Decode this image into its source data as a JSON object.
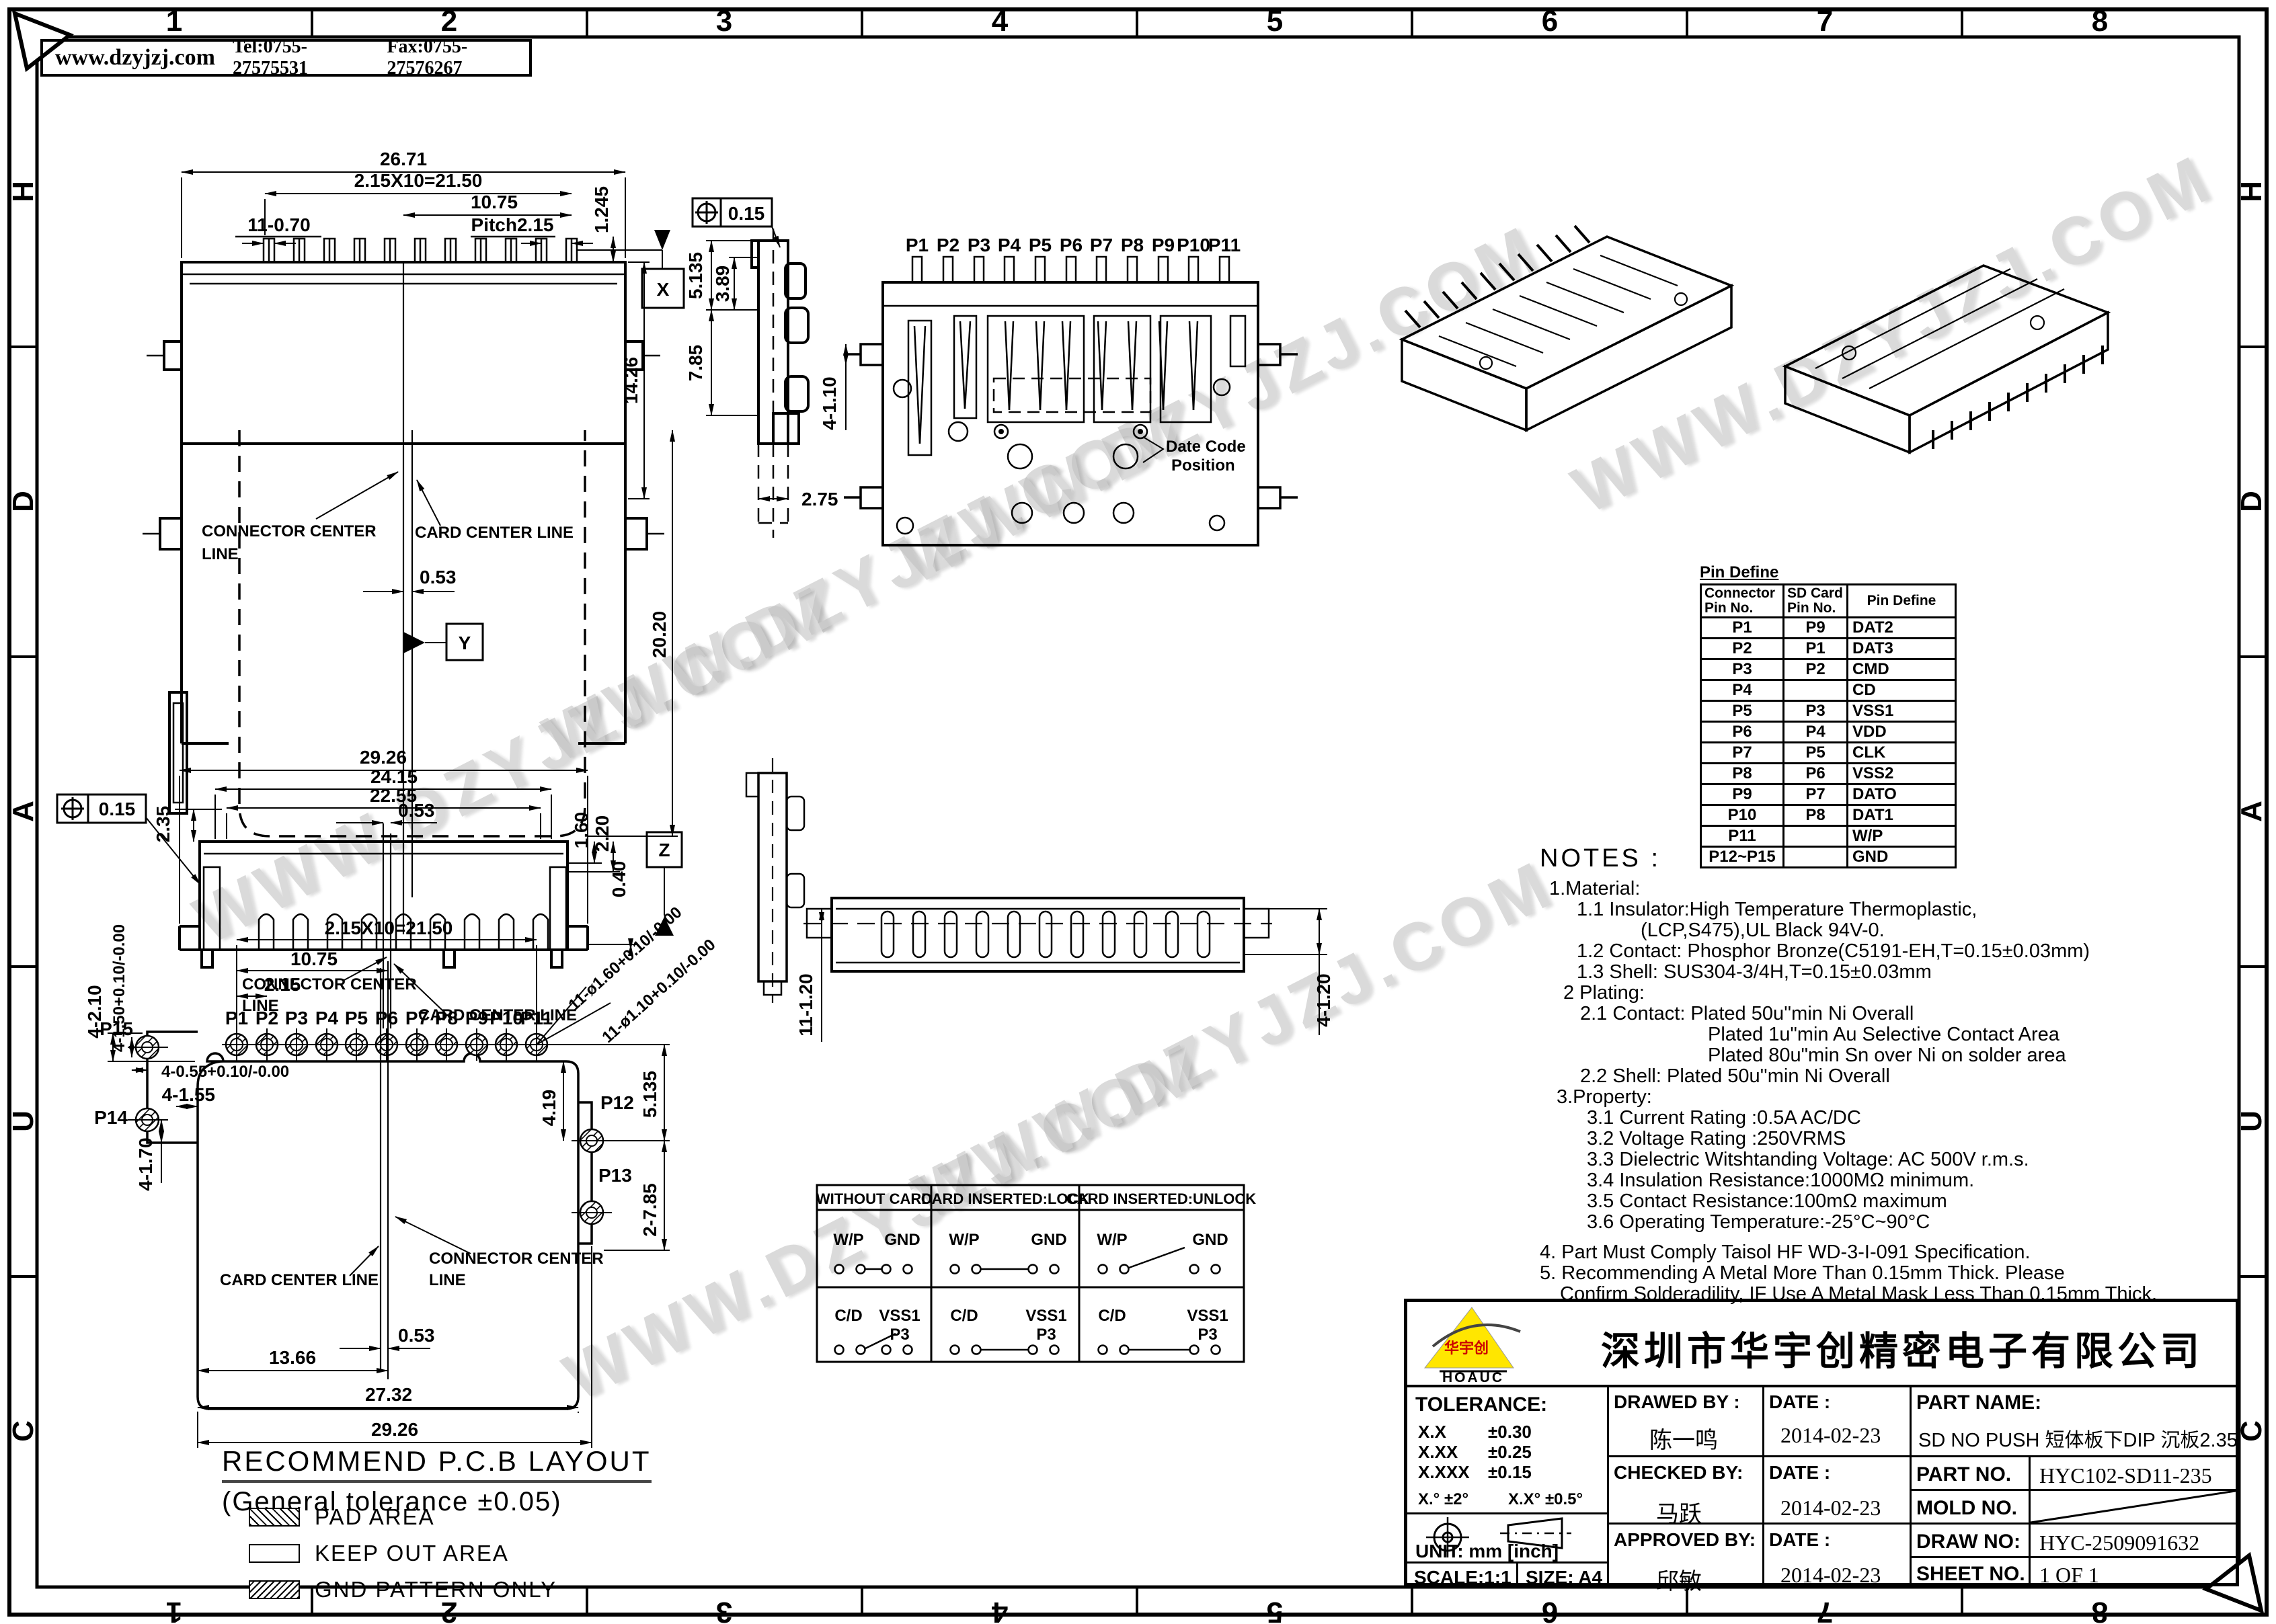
{
  "page": {
    "website": "www.dzyjzj.com",
    "tel": "Tel:0755-27575531",
    "fax": "Fax:0755-27576267",
    "watermark": "WWW.DZYJZJ.COM",
    "zones_top": [
      "1",
      "2",
      "3",
      "4",
      "5",
      "6",
      "7",
      "8"
    ],
    "zones_bottom": [
      "8",
      "7",
      "6",
      "5",
      "4",
      "3",
      "2",
      "1"
    ],
    "zones_left": [
      "H",
      "D",
      "A",
      "U",
      "C"
    ],
    "zones_right": [
      "H",
      "D",
      "A",
      "U",
      "C"
    ]
  },
  "top_view": {
    "dim_26_71": "26.71",
    "dim_21_50": "2.15X10=21.50",
    "dim_10_75": "10.75",
    "dim_pitch": "Pitch2.15",
    "dim_11_070": "11-0.70",
    "dim_1_245": "1.245",
    "dim_14_26": "14.26",
    "dim_20_20": "20.20",
    "dim_0_53": "0.53",
    "datum_x": "X",
    "datum_y": "Y",
    "connector_center_1": "CONNECTOR CENTER",
    "connector_center_2": "LINE",
    "card_center": "CARD CENTER LINE"
  },
  "side_view": {
    "fcf": "0.15",
    "dim_5_135": "5.135",
    "dim_3_89": "3.89",
    "dim_7_85": "7.85",
    "dim_2_75": "2.75"
  },
  "bottom_view_top": {
    "pins": [
      "P1",
      "P2",
      "P3",
      "P4",
      "P5",
      "P6",
      "P7",
      "P8",
      "P9",
      "P10",
      "P11"
    ],
    "date_code_1": "Date Code",
    "date_code_2": "Position",
    "dim_4_110": "4-1.10"
  },
  "front_view": {
    "dim_29_26": "29.26",
    "dim_24_15": "24.15",
    "dim_22_55": "22.55",
    "dim_0_53": "0.53",
    "dim_2_35": "2.35",
    "fcf": "0.15",
    "dim_1_60": "1.60",
    "dim_2_20": "2.20",
    "dim_0_40": "0.40",
    "datum_z": "Z",
    "connector_center_1": "CONNECTOR CENTER",
    "connector_center_2": "LINE",
    "card_center": "CARD CENTER LINE"
  },
  "bottom_view2": {
    "dim_11_120": "11-1.20",
    "dim_4_120": "4-1.20"
  },
  "pcb": {
    "dim_21_50": "2.15X10=21.50",
    "dim_10_75": "10.75",
    "dim_2_15": "2.15",
    "pins": [
      "P1",
      "P2",
      "P3",
      "P4",
      "P5",
      "P6",
      "P7",
      "P8",
      "P9",
      "P10",
      "P11"
    ],
    "hole_160": "11-ø1.60+0.10/-0.00",
    "hole_110": "11-ø1.10+0.10/-0.00",
    "dim_4_19": "4.19",
    "dim_5_135": "5.135",
    "dim_2_785": "2-7.85",
    "p12": "P12",
    "p13": "P13",
    "p14": "P14",
    "p15": "P15",
    "dim_4_210": "4-2.10",
    "dim_4_150": "4-1.50+0.10/-0.00",
    "dim_4_055": "4-0.55+0.10/-0.00",
    "dim_4_155": "4-1.55",
    "dim_4_170": "4-1.70",
    "card_center": "CARD CENTER LINE",
    "connector_center_1": "CONNECTOR CENTER",
    "connector_center_2": "LINE",
    "dim_0_53": "0.53",
    "dim_13_66": "13.66",
    "dim_27_32": "27.32",
    "dim_29_26": "29.26",
    "title": "RECOMMEND P.C.B LAYOUT",
    "subtitle": "(General tolerance ±0.05)",
    "legend": [
      {
        "label": "PAD AREA"
      },
      {
        "label": "KEEP OUT AREA"
      },
      {
        "label": "GND PATTERN ONLY"
      }
    ]
  },
  "switch_table": {
    "headers": [
      "WITHOUT CARD",
      "CARD INSERTED:LOCK",
      "CARD INSERTED:UNLOCK"
    ],
    "wp": "W/P",
    "gnd": "GND",
    "cd": "C/D",
    "vss1": "VSS1",
    "p3": "P3"
  },
  "pin_table": {
    "title": "Pin Define",
    "col1a": "Connector",
    "col1b": "Pin No.",
    "col2a": "SD Card",
    "col2b": "Pin No.",
    "col3": "Pin Define",
    "rows": [
      [
        "P1",
        "P9",
        "DAT2"
      ],
      [
        "P2",
        "P1",
        "DAT3"
      ],
      [
        "P3",
        "P2",
        "CMD"
      ],
      [
        "P4",
        "",
        "CD"
      ],
      [
        "P5",
        "P3",
        "VSS1"
      ],
      [
        "P6",
        "P4",
        "VDD"
      ],
      [
        "P7",
        "P5",
        "CLK"
      ],
      [
        "P8",
        "P6",
        "VSS2"
      ],
      [
        "P9",
        "P7",
        "DATO"
      ],
      [
        "P10",
        "P8",
        "DAT1"
      ],
      [
        "P11",
        "",
        "W/P"
      ],
      [
        "P12~P15",
        "",
        "GND"
      ]
    ]
  },
  "notes": {
    "title": "NOTES :",
    "lines": [
      "1.Material:",
      "1.1 Insulator:High Temperature Thermoplastic,",
      "(LCP,S475),UL Black 94V-0.",
      "1.2 Contact: Phosphor Bronze(C5191-EH,T=0.15±0.03mm)",
      "1.3 Shell: SUS304-3/4H,T=0.15±0.03mm",
      "2 Plating:",
      "2.1 Contact: Plated 50u''min Ni Overall",
      "Plated 1u\"min Au Selective Contact Area",
      "Plated 80u\"min Sn over Ni on solder area",
      "2.2 Shell: Plated 50u''min Ni Overall",
      "3.Property:",
      "3.1 Current Rating :0.5A AC/DC",
      "3.2 Voltage Rating :250VRMS",
      "3.3 Dielectric Witshtanding Voltage: AC 500V r.m.s.",
      "3.4 Insulation Resistance:1000MΩ minimum.",
      "3.5 Contact Resistance:100mΩ maximum",
      "3.6 Operating Temperature:-25°C~90°C",
      "4. Part Must Comply Taisol HF WD-3-I-091 Specification.",
      "5. Recommending A Metal More Than  0.15mm Thick. Please",
      "Confirm Solderadility, IF Use A Metal Mask Less Than 0.15mm Thick."
    ]
  },
  "title_block": {
    "company": "深圳市华宇创精密电子有限公司",
    "logo_text": "华宇创",
    "logo_sub": "HOAUC",
    "tolerance_title": "TOLERANCE:",
    "tol1": "X.X",
    "tol1v": "±0.30",
    "tol2": "X.XX",
    "tol2v": "±0.25",
    "tol3": "X.XXX",
    "tol3v": "±0.15",
    "tol_deg": "X.° ±2°",
    "tol_deg2": "X.X° ±0.5°",
    "unit": "UNIT: mm [inch]",
    "scale": "SCALE:1:1",
    "size": "SIZE: A4",
    "drawed_label": "DRAWED BY :",
    "drawed": "陈一鸣",
    "checked_label": "CHECKED BY:",
    "checked": "马跃",
    "approved_label": "APPROVED BY:",
    "approved": "邱敏",
    "date_label1": "DATE :",
    "date_label2": "DATE :",
    "date_label3": "DATE :",
    "date1": "2014-02-23",
    "date2": "2014-02-23",
    "date3": "2014-02-23",
    "part_name_label": "PART NAME:",
    "part_name": "SD NO PUSH 短体板下DIP 沉板2.35",
    "part_no_label": "PART NO.",
    "part_no": "HYC102-SD11-235",
    "mold_no_label": "MOLD NO.",
    "draw_no_label": "DRAW NO:",
    "draw_no": "HYC-2509091632",
    "sheet_no_label": "SHEET NO.",
    "sheet_no": "1 OF 1"
  }
}
